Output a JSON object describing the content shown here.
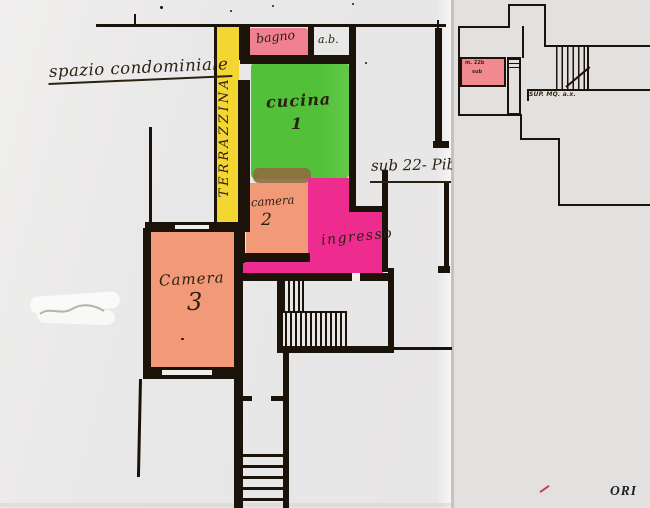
{
  "document": {
    "kind": "scanned hand-coloured floor plan, two overlapping sheets",
    "stamp_fragment": "ORI"
  },
  "main_plan": {
    "annotations": {
      "spazio": "spazio condominiale",
      "sub": "sub 22- Pib"
    },
    "rooms": {
      "terrazzina": {
        "label": "TERRAZZINA",
        "color": "#f3d632"
      },
      "bagno": {
        "label": "bagno",
        "color": "#ef8090"
      },
      "antibagno": {
        "label": "a.b."
      },
      "cucina": {
        "label": "cucina",
        "number": "1",
        "color": "#55c23c"
      },
      "camera2": {
        "label": "camera",
        "number": "2",
        "color": "#f29a77"
      },
      "ingresso": {
        "label": "ingresso",
        "color": "#ee2b8e"
      },
      "camera3": {
        "label": "Camera",
        "number": "3",
        "color": "#f29a77"
      }
    }
  },
  "inset_plan": {
    "pink_area": {
      "line1": "m. 22b",
      "line2": "sub",
      "color": "#f18a90"
    },
    "sup_label": "SUP. MQ. a.x."
  },
  "colors": {
    "wall": "#1b1309",
    "ink": "#2b2113",
    "paper_main": "#e8e7e6",
    "paper_right": "#e3e1df",
    "whiteout": "#fafaf8",
    "red_mark": "#cf3b55"
  }
}
